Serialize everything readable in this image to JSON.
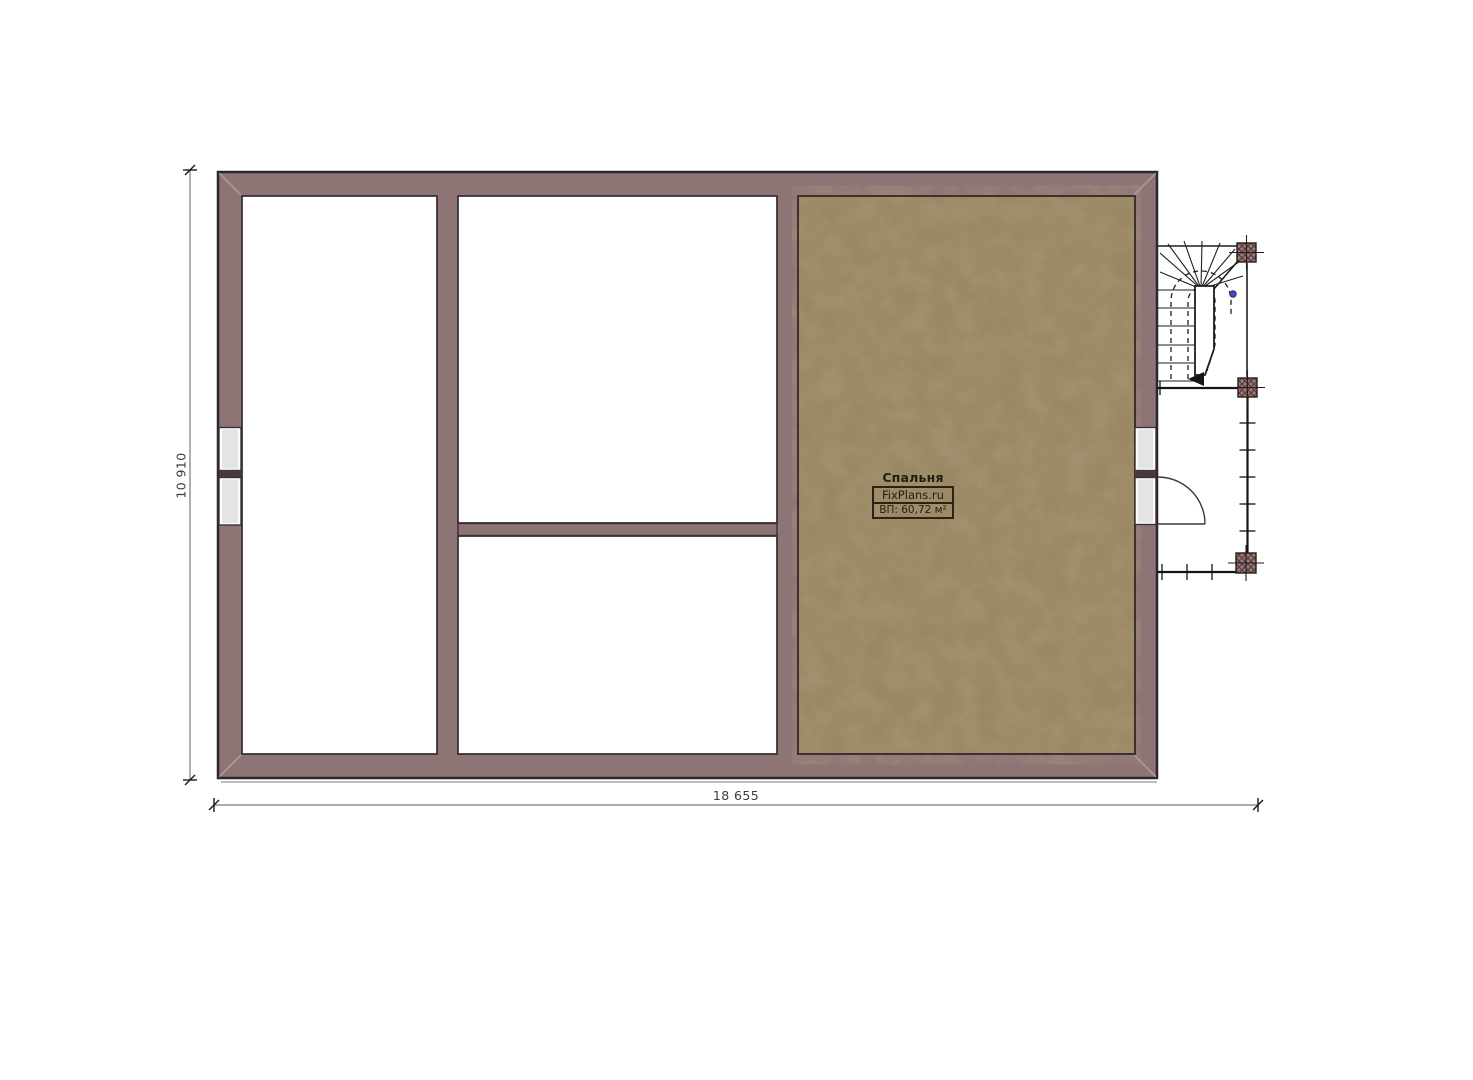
{
  "plan": {
    "bedroom": {
      "name": "Спальня",
      "brand": "FixPlans.ru",
      "area": "ВП: 60,72 м²"
    }
  },
  "dimensions": {
    "height_mm": "10 910",
    "width_mm": "18 655"
  },
  "colors": {
    "background": "#ffffff",
    "wall": "#8e7575",
    "wall_outline": "#2e2628",
    "inner_line": "#3b3133",
    "floor": "#9a8763",
    "window_glass": "#e4e4e4",
    "mullion": "#463a3c",
    "stair_line": "#1e1e1e",
    "post_fill": "#9b7a78",
    "post_hatch": "#5c3d3d",
    "dim_line": "#7a7a7a",
    "dim_text": "#3a3a3a",
    "accent_dot": "#4747c8",
    "label_border": "#2a2214",
    "label_text": "#221d13",
    "shadow_line": "#a6a6a6"
  }
}
